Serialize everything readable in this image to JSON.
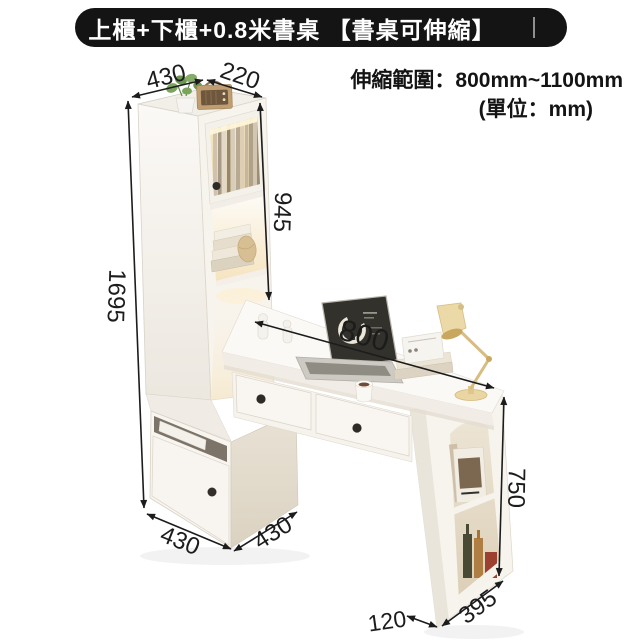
{
  "title_bar": {
    "text": "上櫃+下櫃+0.8米書桌 【書桌可伸縮】"
  },
  "spec": {
    "range": "伸縮範圍：800mm~1100mm",
    "unit": "(單位：mm)"
  },
  "dimensions": {
    "cabinet_top_width": "430",
    "cabinet_top_depth": "220",
    "upper_cabinet_height": "945",
    "total_height": "1695",
    "desk_length": "800",
    "desk_height": "750",
    "side_shelf_depth": "395",
    "side_shelf_width": "120",
    "lower_cabinet_width": "430",
    "lower_cabinet_depth": "430"
  },
  "illustration": {
    "items": [
      "bookcase-cabinet",
      "glass-door",
      "book-shelf",
      "lower-cabinet",
      "desk",
      "drawers",
      "side-shelf-unit",
      "laptop",
      "desk-lamp",
      "potted-plant",
      "retro-radio",
      "coffee-cup",
      "books",
      "magazine",
      "bottles",
      "figurines"
    ]
  },
  "colors": {
    "line_black": "#1c1c1c",
    "cabinet_white": "#f7f4ee",
    "side_beige": "#e3dbcb",
    "warm_light": "#f5dca6",
    "lamp_yellow": "#e9d6a2"
  }
}
